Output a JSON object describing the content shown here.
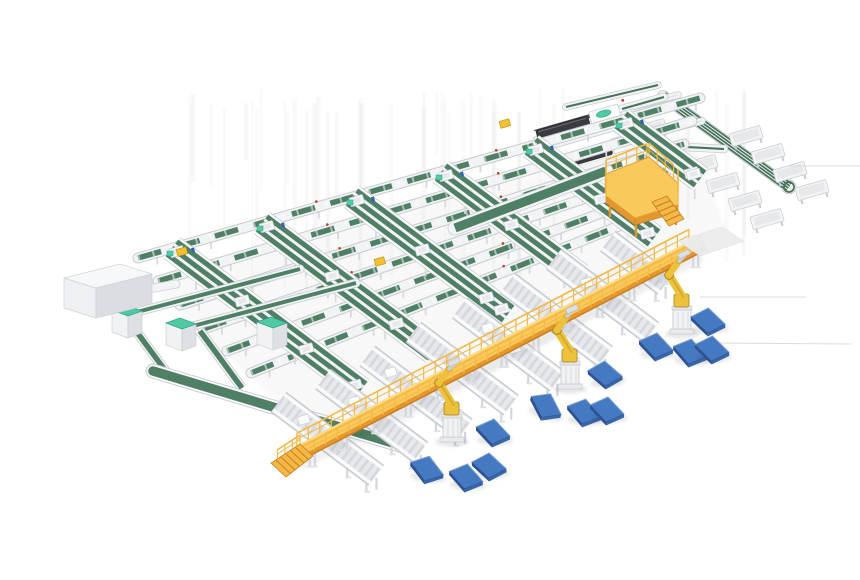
{
  "scene": {
    "palette": {
      "bg": "#ffffff",
      "green": "#4f8066",
      "green_dark": "#2f5a45",
      "green_mid": "#457258",
      "teal": "#4ecaa6",
      "teal_dark": "#2ea183",
      "frame": "#f2f3f5",
      "frame_edge": "#c7cbd1",
      "frame_inner": "#e6e8eb",
      "roller": "#d4d7dc",
      "yellow_top": "#fac95c",
      "yellow_mid": "#f3b845",
      "yellow_side": "#e5972e",
      "yellow_dark": "#c97f22",
      "robot_yellow": "#ecc23d",
      "robot_shade": "#d9ab2c",
      "robot_dark": "#a97f1a",
      "blue_top": "#4579c1",
      "blue_side": "#2d5294",
      "blue_front": "#3a66a8",
      "blue_hi": "#85a9dc",
      "machine_dark": "#383b3f",
      "machine_top": "#54585c",
      "machine_edge": "#202225",
      "red": "#c0392b",
      "blue_bit": "#2f63b4",
      "shadow": "#3a3f46",
      "streak": "#6b6f76",
      "streak_line": "#d8d8d8",
      "slab": "#ebedef",
      "parcel_yellow": "#f2c12f",
      "parcel_edge": "#c8941f",
      "leg": "#d3d6db",
      "white": "#ffffff"
    },
    "spines": [
      {
        "x1": 138,
        "y1": 258,
        "x2": 700,
        "y2": 98
      },
      {
        "x1": 158,
        "y1": 281,
        "x2": 692,
        "y2": 121
      },
      {
        "x1": 180,
        "y1": 305,
        "x2": 684,
        "y2": 144
      },
      {
        "x1": 203,
        "y1": 329,
        "x2": 673,
        "y2": 168
      },
      {
        "x1": 227,
        "y1": 351,
        "x2": 661,
        "y2": 191
      },
      {
        "x1": 251,
        "y1": 373,
        "x2": 649,
        "y2": 214
      }
    ],
    "lanes": [
      {
        "x1": 172,
        "y1": 248,
        "x2": 361,
        "y2": 390
      },
      {
        "x1": 262,
        "y1": 223,
        "x2": 434,
        "y2": 352
      },
      {
        "x1": 352,
        "y1": 197,
        "x2": 508,
        "y2": 314
      },
      {
        "x1": 441,
        "y1": 172,
        "x2": 580,
        "y2": 276
      },
      {
        "x1": 531,
        "y1": 146,
        "x2": 654,
        "y2": 238
      },
      {
        "x1": 621,
        "y1": 120,
        "x2": 700,
        "y2": 179
      }
    ],
    "wide_belt": {
      "x1": 455,
      "y1": 228,
      "x2": 606,
      "y2": 171
    },
    "left_machine": {
      "x": 100,
      "y": 290
    },
    "left_connector": {
      "x1": 148,
      "y1": 289,
      "x2": 176,
      "y2": 284
    },
    "left_loop": {
      "runs": [
        {
          "x1": 137,
          "y1": 312,
          "x2": 300,
          "y2": 269
        },
        {
          "x1": 193,
          "y1": 326,
          "x2": 356,
          "y2": 283
        }
      ],
      "drops": [
        {
          "x1": 128,
          "y1": 320,
          "x2": 170,
          "y2": 377
        },
        {
          "x1": 200,
          "y1": 331,
          "x2": 242,
          "y2": 388
        }
      ],
      "collector": {
        "x1": 153,
        "y1": 371,
        "x2": 413,
        "y2": 449
      },
      "cabinets": [
        {
          "x": 127,
          "y": 318
        },
        {
          "x": 181,
          "y": 331
        },
        {
          "x": 272,
          "y": 330
        }
      ]
    },
    "dark_machines": [
      {
        "x": 584,
        "y": 125
      },
      {
        "x": 606,
        "y": 152
      }
    ],
    "outfeed_rails": [
      {
        "x1": 612,
        "y1": 112,
        "x2": 678,
        "y2": 95,
        "w": 6,
        "green": false
      },
      {
        "x1": 632,
        "y1": 139,
        "x2": 702,
        "y2": 121,
        "w": 6,
        "green": false
      },
      {
        "x1": 566,
        "y1": 107,
        "x2": 658,
        "y2": 85,
        "w": 6,
        "green": true
      },
      {
        "x1": 668,
        "y1": 146,
        "x2": 724,
        "y2": 149,
        "w": 7,
        "green": true
      },
      {
        "x1": 622,
        "y1": 109,
        "x2": 664,
        "y2": 97,
        "w": 7,
        "green": true
      }
    ],
    "loop": {
      "x1": 663,
      "y1": 96,
      "x2": 789,
      "y2": 187,
      "tables_upper": [
        [
          746,
          136
        ],
        [
          768,
          154
        ],
        [
          790,
          172
        ],
        [
          812,
          190
        ]
      ],
      "tables_lower": [
        [
          701,
          165
        ],
        [
          723,
          183
        ],
        [
          745,
          201
        ],
        [
          767,
          219
        ]
      ],
      "tables_side": [
        [
          655,
          105
        ],
        [
          650,
          129
        ]
      ]
    },
    "platform": {
      "floor": [
        [
          606,
          196
        ],
        [
          606,
          174
        ],
        [
          649,
          157
        ],
        [
          678,
          183
        ],
        [
          678,
          205
        ],
        [
          635,
          218
        ]
      ],
      "rail_chain": [
        [
          606,
          196
        ],
        [
          606,
          174
        ],
        [
          649,
          157
        ],
        [
          678,
          183
        ],
        [
          678,
          205
        ]
      ],
      "sides": [
        [
          [
            606,
            196
          ],
          [
            635,
            218
          ],
          [
            635,
            225
          ],
          [
            606,
            203
          ]
        ],
        [
          [
            635,
            218
          ],
          [
            678,
            205
          ],
          [
            678,
            212
          ],
          [
            635,
            225
          ]
        ]
      ],
      "legs": [
        [
          610,
          201
        ],
        [
          636,
          221
        ],
        [
          676,
          209
        ],
        [
          606,
          178
        ]
      ],
      "stairs": {
        "pts": [
          [
            652,
            202
          ],
          [
            667,
            196
          ],
          [
            684,
            219
          ],
          [
            669,
            226
          ]
        ],
        "steps": 5
      }
    },
    "walkway": {
      "x1": 300,
      "y1": 452,
      "x2": 702,
      "y2": 243,
      "ramp": [
        [
          300,
          444
        ],
        [
          313,
          456
        ],
        [
          286,
          477
        ],
        [
          271,
          463
        ]
      ],
      "leg_step": 36,
      "rail_post_step": 13
    },
    "chutes": [
      {
        "s": 30,
        "parcels": [
          -28,
          6
        ]
      },
      {
        "s": 80,
        "parcels": [
          -20
        ]
      },
      {
        "s": 130,
        "parcels": [
          -30,
          4
        ]
      },
      {
        "s": 182,
        "parcels": [
          8
        ]
      },
      {
        "s": 234,
        "parcels": [
          -24,
          10
        ]
      },
      {
        "s": 288,
        "parcels": []
      },
      {
        "s": 340,
        "parcels": [
          -18
        ]
      },
      {
        "s": 392,
        "parcels": [],
        "short": true
      }
    ],
    "robots": [
      {
        "x": 452,
        "y": 440
      },
      {
        "x": 570,
        "y": 387
      },
      {
        "x": 682,
        "y": 332
      }
    ],
    "pallets": [
      [
        427,
        469,
        6
      ],
      [
        466,
        477,
        2
      ],
      [
        489,
        466,
        -4
      ],
      [
        493,
        432,
        0
      ],
      [
        546,
        406,
        16
      ],
      [
        584,
        412,
        3
      ],
      [
        607,
        410,
        0
      ],
      [
        605,
        374,
        -6
      ],
      [
        656,
        346,
        0
      ],
      [
        708,
        321,
        -3
      ],
      [
        690,
        352,
        2
      ],
      [
        712,
        349,
        -2
      ]
    ],
    "slab": [
      [
        678,
        241
      ],
      [
        722,
        227
      ],
      [
        744,
        241
      ],
      [
        700,
        256
      ]
    ],
    "streaks_h": [
      [
        700,
        297,
        806,
        297
      ],
      [
        718,
        343,
        852,
        344
      ],
      [
        788,
        166,
        860,
        166
      ]
    ],
    "streaks_v": {
      "count": 42,
      "x0": 168,
      "x1": 768,
      "y0": 88,
      "h_min": 55,
      "h_max": 200
    },
    "parcels_yellow": [
      [
        182,
        252
      ],
      [
        380,
        262
      ],
      [
        505,
        124
      ]
    ]
  }
}
